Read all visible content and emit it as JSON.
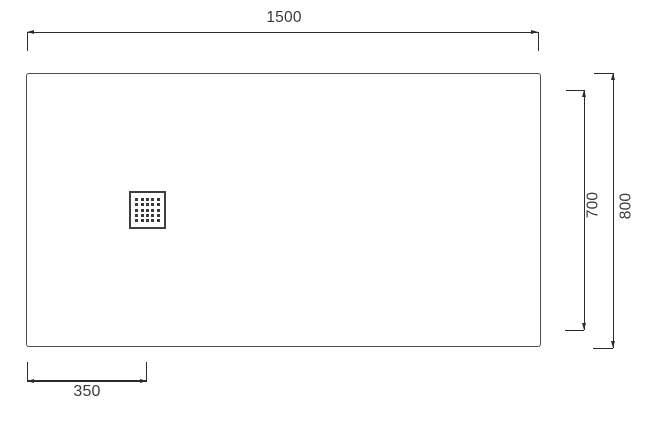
{
  "drawing": {
    "colors": {
      "outline": "#4f4f4f",
      "dimension_line": "#2b2b2b",
      "text": "#3a3a3a",
      "background": "#ffffff",
      "drain_holes": "#3a3a3a"
    },
    "dimensions": {
      "width_label": "1500",
      "height_label": "800",
      "inner_height_label": "700",
      "drain_offset_label": "350"
    },
    "drain": {
      "rows": 5,
      "cols": 5
    }
  }
}
